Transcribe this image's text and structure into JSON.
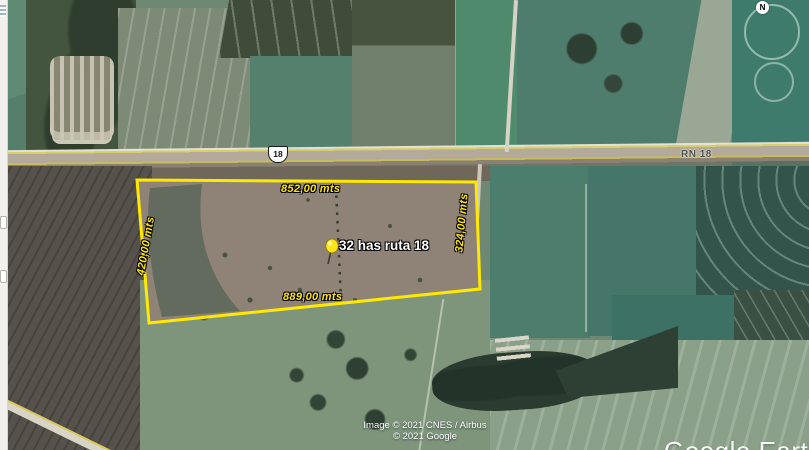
{
  "app": {
    "watermark": "Google Earth",
    "attribution_line1": "Image © 2021 CNES / Airbus",
    "attribution_line2": "© 2021 Google",
    "compass_label": "N"
  },
  "roads": {
    "route_shield": "18",
    "route_name": "RN 18"
  },
  "parcel": {
    "placemark_label": "32 has ruta 18",
    "top_side": "852,00 mts",
    "bottom_side": "889,00 mts",
    "left_side": "420,00 mts",
    "right_side": "324,00 mts",
    "outline_color": "#ffe900",
    "measure_label_color": "#ffe400",
    "placemark_icon": "yellow-pushpin-icon"
  }
}
